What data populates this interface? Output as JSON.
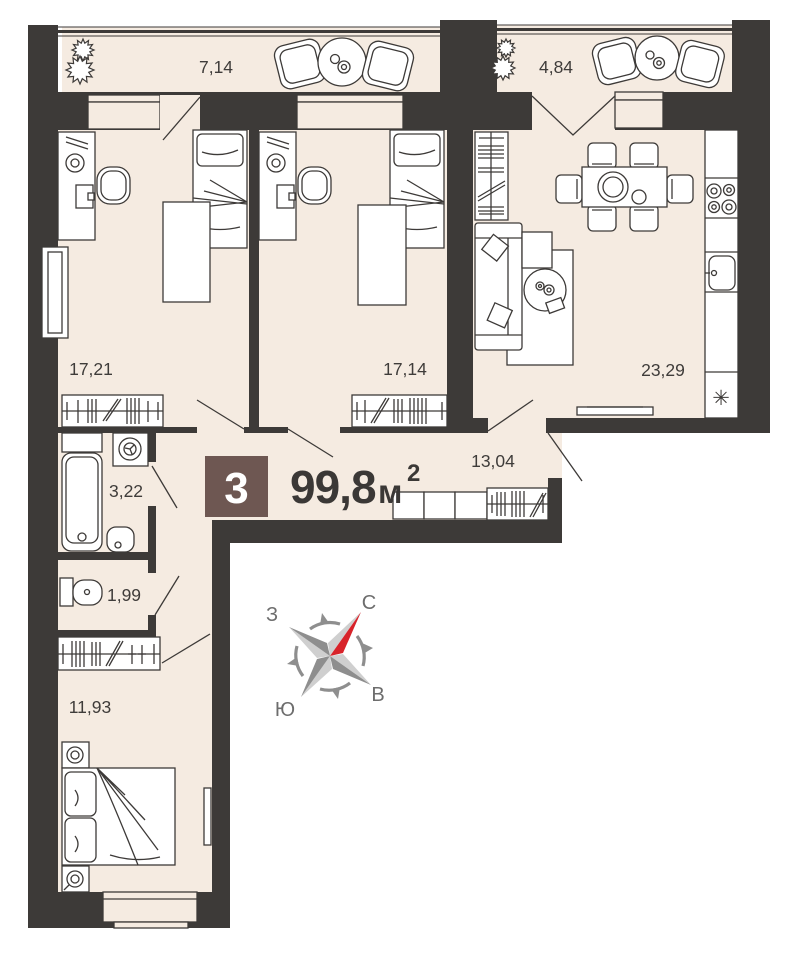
{
  "floorplan": {
    "badge_rooms_count": "3",
    "total_area": "99,8",
    "area_unit": "м",
    "area_sup": "2",
    "rooms": [
      {
        "name": "balcony-left",
        "area": "7,14"
      },
      {
        "name": "balcony-right",
        "area": "4,84"
      },
      {
        "name": "bedroom-1",
        "area": "17,21"
      },
      {
        "name": "bedroom-2",
        "area": "17,14"
      },
      {
        "name": "kitchen-living-room",
        "area": "23,29"
      },
      {
        "name": "hallway",
        "area": "13,04"
      },
      {
        "name": "bathroom",
        "area": "3,22"
      },
      {
        "name": "toilet",
        "area": "1,99"
      },
      {
        "name": "bedroom-3",
        "area": "11,93"
      }
    ],
    "compass": {
      "north": "С",
      "east": "В",
      "south": "Ю",
      "west": "З"
    },
    "colors": {
      "wall": "#3d3a38",
      "floor": "#f5ebe1",
      "badge": "#6e5752",
      "needle_red": "#d8232a"
    },
    "kitchen_sink_symbol": "✳"
  }
}
